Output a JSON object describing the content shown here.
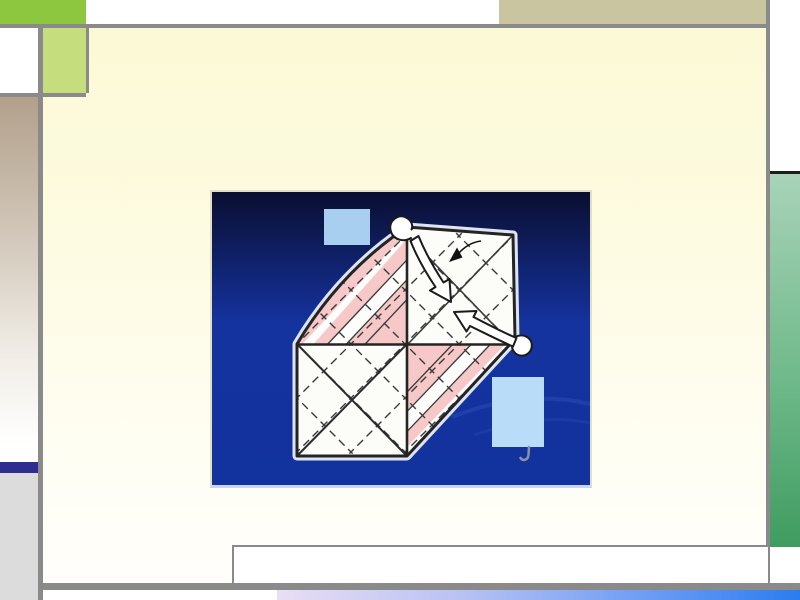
{
  "app": {
    "kind": "presentation-slide",
    "title": ""
  },
  "slide": {
    "text": [],
    "content_image": {
      "subject": "origami-folding-diagram",
      "elements": [
        "origami-sheet",
        "fold-arrow-down-icon",
        "fold-arrow-up-icon",
        "small-fold-arrow-icon",
        "callout-box-top",
        "callout-box-bottom",
        "callout-pointer-line"
      ]
    }
  },
  "colors": {
    "frame_line": "#8a8a8a",
    "accent_green": "#8dc63f",
    "light_green": "#c6dd7d",
    "olive_tan": "#c9c5a0",
    "tan_top": "#b2a08b",
    "navy_accent": "#2e2e8f",
    "left_gray": "#dcdcdc",
    "cream_top": "#fcf9d6",
    "mint_top": "#a8d3b8",
    "green_bottom": "#3f9c60",
    "bar_lavender": "#e9def5",
    "bar_blue": "#2b7cf0",
    "image_bg_top": "#0a0e30",
    "image_bg_blue": "#15339f",
    "paper_white": "#fcfcf9",
    "paper_pink": "#f6c8c8",
    "fold_line": "#3a3a3a",
    "callout_blue_top": "#a9cff0",
    "callout_blue_bottom": "#b9dcf8"
  }
}
